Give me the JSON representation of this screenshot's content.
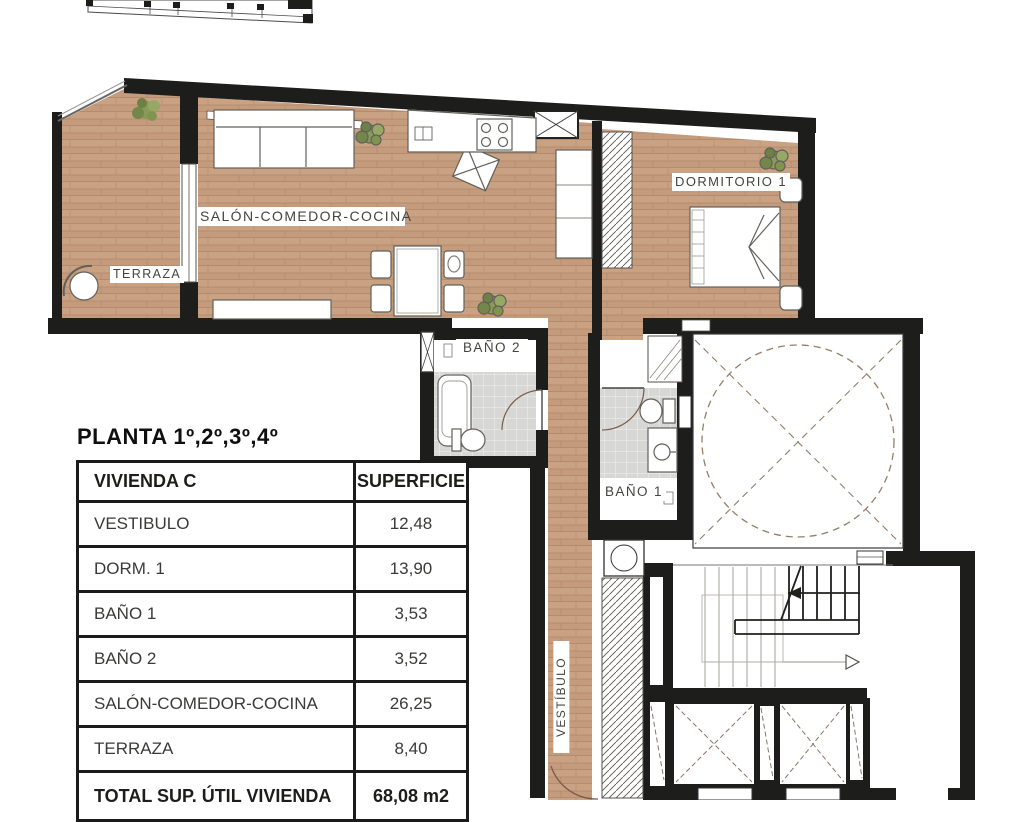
{
  "plan": {
    "title": "PLANTA 1º,2º,3º,4º",
    "rooms": {
      "salon": "SALÓN-COMEDOR-COCINA",
      "terraza": "TERRAZA",
      "dormitorio": "DORMITORIO 1",
      "bano2": "BAÑO 2",
      "bano1": "BAÑO 1",
      "vestibulo": "VESTÍBULO"
    },
    "colors": {
      "wall": "#1d1d1b",
      "wood": "#c9a183",
      "tile": "#d7d7d5",
      "plant_green": "#81944f",
      "dash_brown": "#937f66"
    }
  },
  "table": {
    "header": {
      "col1": "VIVIENDA C",
      "col2": "SUPERFICIE"
    },
    "rows": [
      {
        "name": "VESTIBULO",
        "value": "12,48"
      },
      {
        "name": "DORM. 1",
        "value": "13,90"
      },
      {
        "name": "BAÑO 1",
        "value": "3,53"
      },
      {
        "name": "BAÑO 2",
        "value": "3,52"
      },
      {
        "name": "SALÓN-COMEDOR-COCINA",
        "value": "26,25"
      },
      {
        "name": "TERRAZA",
        "value": "8,40"
      }
    ],
    "total": {
      "name": "TOTAL SUP. ÚTIL VIVIENDA",
      "value": "68,08 m2"
    }
  }
}
